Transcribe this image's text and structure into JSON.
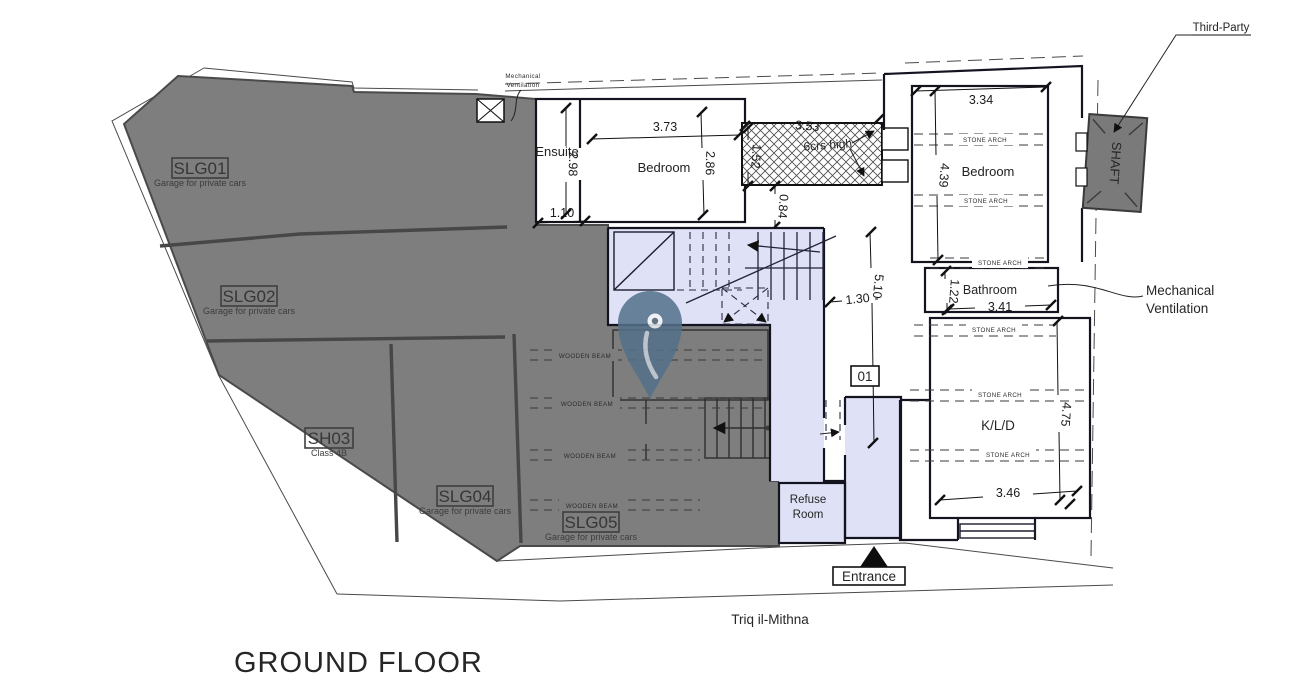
{
  "title": "GROUND FLOOR",
  "street_label": "Triq il-Mithna",
  "entrance_label": "Entrance",
  "third_party_label": "Third-Party",
  "shaft_label": "SHAFT",
  "unit_marker": "01",
  "mech_vent_right": {
    "line1": "Mechanical",
    "line2": "Ventilation"
  },
  "mech_vent_top": {
    "line1": "Mechanical",
    "line2": "Ventilation"
  },
  "notes": {
    "stone_arch": "STONE ARCH",
    "wooden_beam": "WOODEN BEAM",
    "courses_high": "6crs high"
  },
  "garages": {
    "slg01": {
      "code": "SLG01",
      "desc": "Garage for private cars"
    },
    "slg02": {
      "code": "SLG02",
      "desc": "Garage for private cars"
    },
    "sh03": {
      "code": "SH03",
      "desc": "Class 4B"
    },
    "slg04": {
      "code": "SLG04",
      "desc": "Garage for private cars"
    },
    "slg05": {
      "code": "SLG05",
      "desc": "Garage for private cars"
    }
  },
  "rooms": {
    "ensuite": "Ensuite",
    "bedroom_top": "Bedroom",
    "bedroom_right": "Bedroom",
    "bathroom": "Bathroom",
    "kld": "K/L/D",
    "refuse_line1": "Refuse",
    "refuse_line2": "Room"
  },
  "dimensions": {
    "ensuite_width": "1.10",
    "ensuite_height": "2.98",
    "bedroom_top_width": "3.73",
    "bedroom_top_height": "2.86",
    "hatch_width": "3.53",
    "hatch_height": "1.52",
    "hatch_offset": "0.84",
    "hall_width": "1.30",
    "hall_length": "5.10",
    "bedroom_right_width": "3.34",
    "bedroom_right_height": "4.39",
    "bathroom_height": "1.22",
    "bathroom_width": "3.41",
    "kld_height": "4.75",
    "kld_width": "3.46"
  },
  "colors": {
    "garage_fill": "#7e7e7e",
    "common_fill": "#dfe1f6",
    "shaft_fill": "#7a7a7a",
    "pin": "#54718a"
  }
}
